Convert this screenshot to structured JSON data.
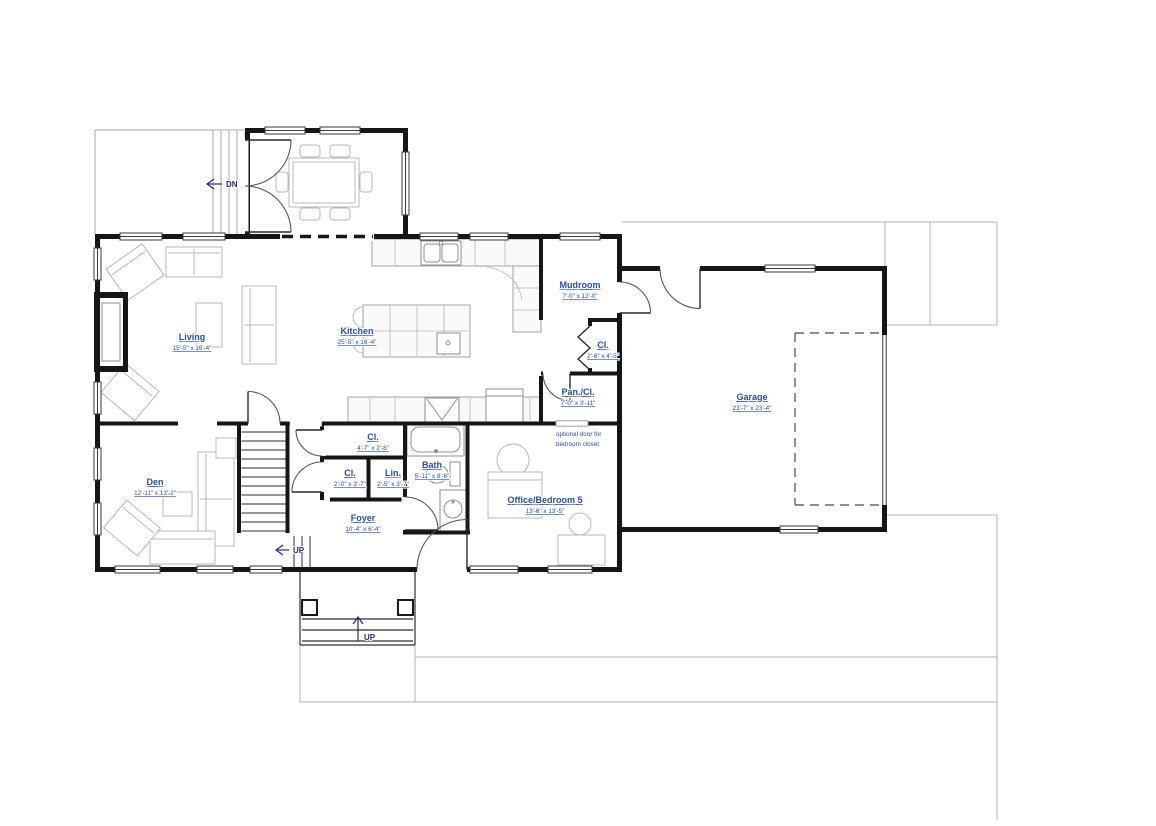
{
  "rooms": {
    "living": {
      "name": "Living",
      "dims": "15'-5\" x 16'-4\""
    },
    "kitchen": {
      "name": "Kitchen",
      "dims": "25'-5\" x 16'-4\""
    },
    "mudroom": {
      "name": "Mudroom",
      "dims": "7'-0\" x 12'-0\""
    },
    "cl_mud": {
      "name": "Cl.",
      "dims": "2'-6\" x 4'-5\""
    },
    "pantry": {
      "name": "Pan./Cl.",
      "dims": "7'-0\" x 3'-11\""
    },
    "garage": {
      "name": "Garage",
      "dims": "23'-7\" x 23'-4\""
    },
    "den": {
      "name": "Den",
      "dims": "12'-11\" x 13'-2\""
    },
    "cl_hall": {
      "name": "Cl.",
      "dims": "4'-7\" x 2'-8\""
    },
    "cl_foyer": {
      "name": "Cl.",
      "dims": "2'-0\" x 3'-7\""
    },
    "linen": {
      "name": "Lin.",
      "dims": "2'-5\" x 3'-7\""
    },
    "bath": {
      "name": "Bath",
      "dims": "5'-11\" x 9'-6\""
    },
    "foyer": {
      "name": "Foyer",
      "dims": "10'-4\" x 6'-4\""
    },
    "office": {
      "name": "Office/Bedroom 5",
      "dims": "13'-6\" x 13'-5\""
    }
  },
  "annotations": {
    "deck_stairs_down": "DN",
    "interior_stairs_up": "UP",
    "porch_steps_up": "UP",
    "optional_door_line1": "optional door for",
    "optional_door_line2": "bedroom closet"
  },
  "colors": {
    "label_blue": "#2b4fa5",
    "nav_blue": "#1f2d7a",
    "wall_black": "#161616",
    "furniture_gray": "#b9b9b9",
    "site_gray": "#b3b3b3"
  }
}
